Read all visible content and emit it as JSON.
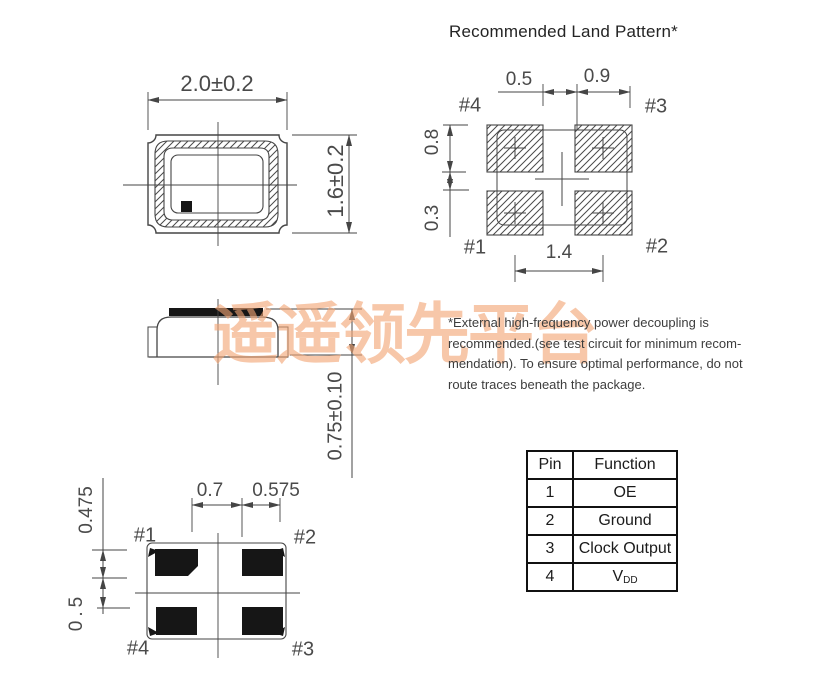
{
  "header": {
    "title": "Recommended Land Pattern*"
  },
  "watermark": {
    "text": "遥遥领先平台"
  },
  "top_view": {
    "width_dim": "2.0±0.2",
    "height_dim": "1.6±0.2"
  },
  "side_view": {
    "height_dim": "0.75±0.10"
  },
  "land_pattern": {
    "dim_gap_x": "0.5",
    "dim_pad_w": "0.9",
    "dim_pad_h": "0.8",
    "dim_gap_y": "0.3",
    "dim_pitch_x": "1.4",
    "pin1": "#1",
    "pin2": "#2",
    "pin3": "#3",
    "pin4": "#4"
  },
  "bottom_view": {
    "dim_pad_w": "0.7",
    "dim_edge": "0.575",
    "dim_pad_h": "0.475",
    "dim_gap_y": "0.5",
    "pin1": "#1",
    "pin2": "#2",
    "pin3": "#3",
    "pin4": "#4"
  },
  "note": {
    "text": "*External high-frequency power decoupling is\nrecommended.(see test circuit for minimum recom-\nmendation).  To ensure optimal performance, do not\nroute traces beneath the package."
  },
  "pin_table": {
    "headers": [
      "Pin",
      "Function"
    ],
    "rows": [
      {
        "pin": "1",
        "function": "OE"
      },
      {
        "pin": "2",
        "function": "Ground"
      },
      {
        "pin": "3",
        "function": "Clock Output"
      },
      {
        "pin": "4",
        "function": "V",
        "function_sub": "DD"
      }
    ]
  },
  "colors": {
    "line": "#454545",
    "pad_fill": "#161616",
    "watermark": "#f2a474"
  }
}
